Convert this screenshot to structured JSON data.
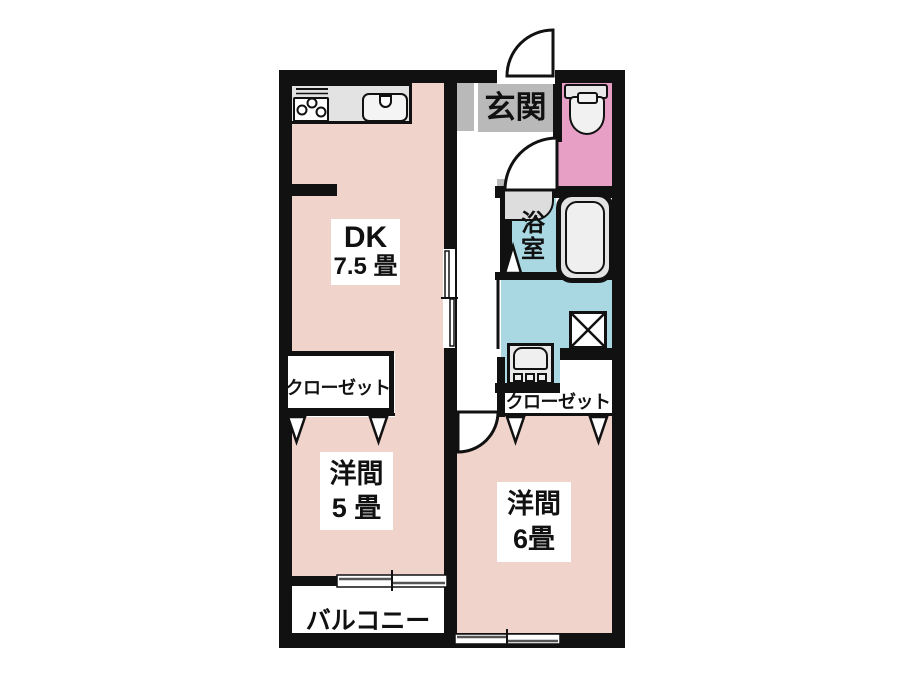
{
  "plan_type": "floor-plan",
  "colors": {
    "room_pink": "#f0d3cb",
    "toilet_pink": "#e79fc6",
    "water_blue": "#a9d8e3",
    "entrance_gray": "#b9b9b9",
    "counter_gray": "#e3e3e3",
    "fixture_gray": "#e9e9e9",
    "wall_black": "#111111",
    "line_gray": "#555555"
  },
  "rooms": {
    "entrance": {
      "label": "玄関"
    },
    "dk": {
      "name": "DK",
      "size": "7.5 畳"
    },
    "bath": {
      "label": "浴室"
    },
    "closet_left": {
      "label": "クローゼット"
    },
    "closet_right": {
      "label": "クローゼット"
    },
    "western5": {
      "name": "洋間",
      "size": "5 畳"
    },
    "western6": {
      "name": "洋間",
      "size": "6畳"
    },
    "balcony": {
      "label": "バルコニー"
    }
  },
  "fixtures": [
    "stove",
    "kitchen-sink",
    "toilet",
    "bathtub",
    "bath-counter",
    "washbasin",
    "washing-machine-pan"
  ]
}
